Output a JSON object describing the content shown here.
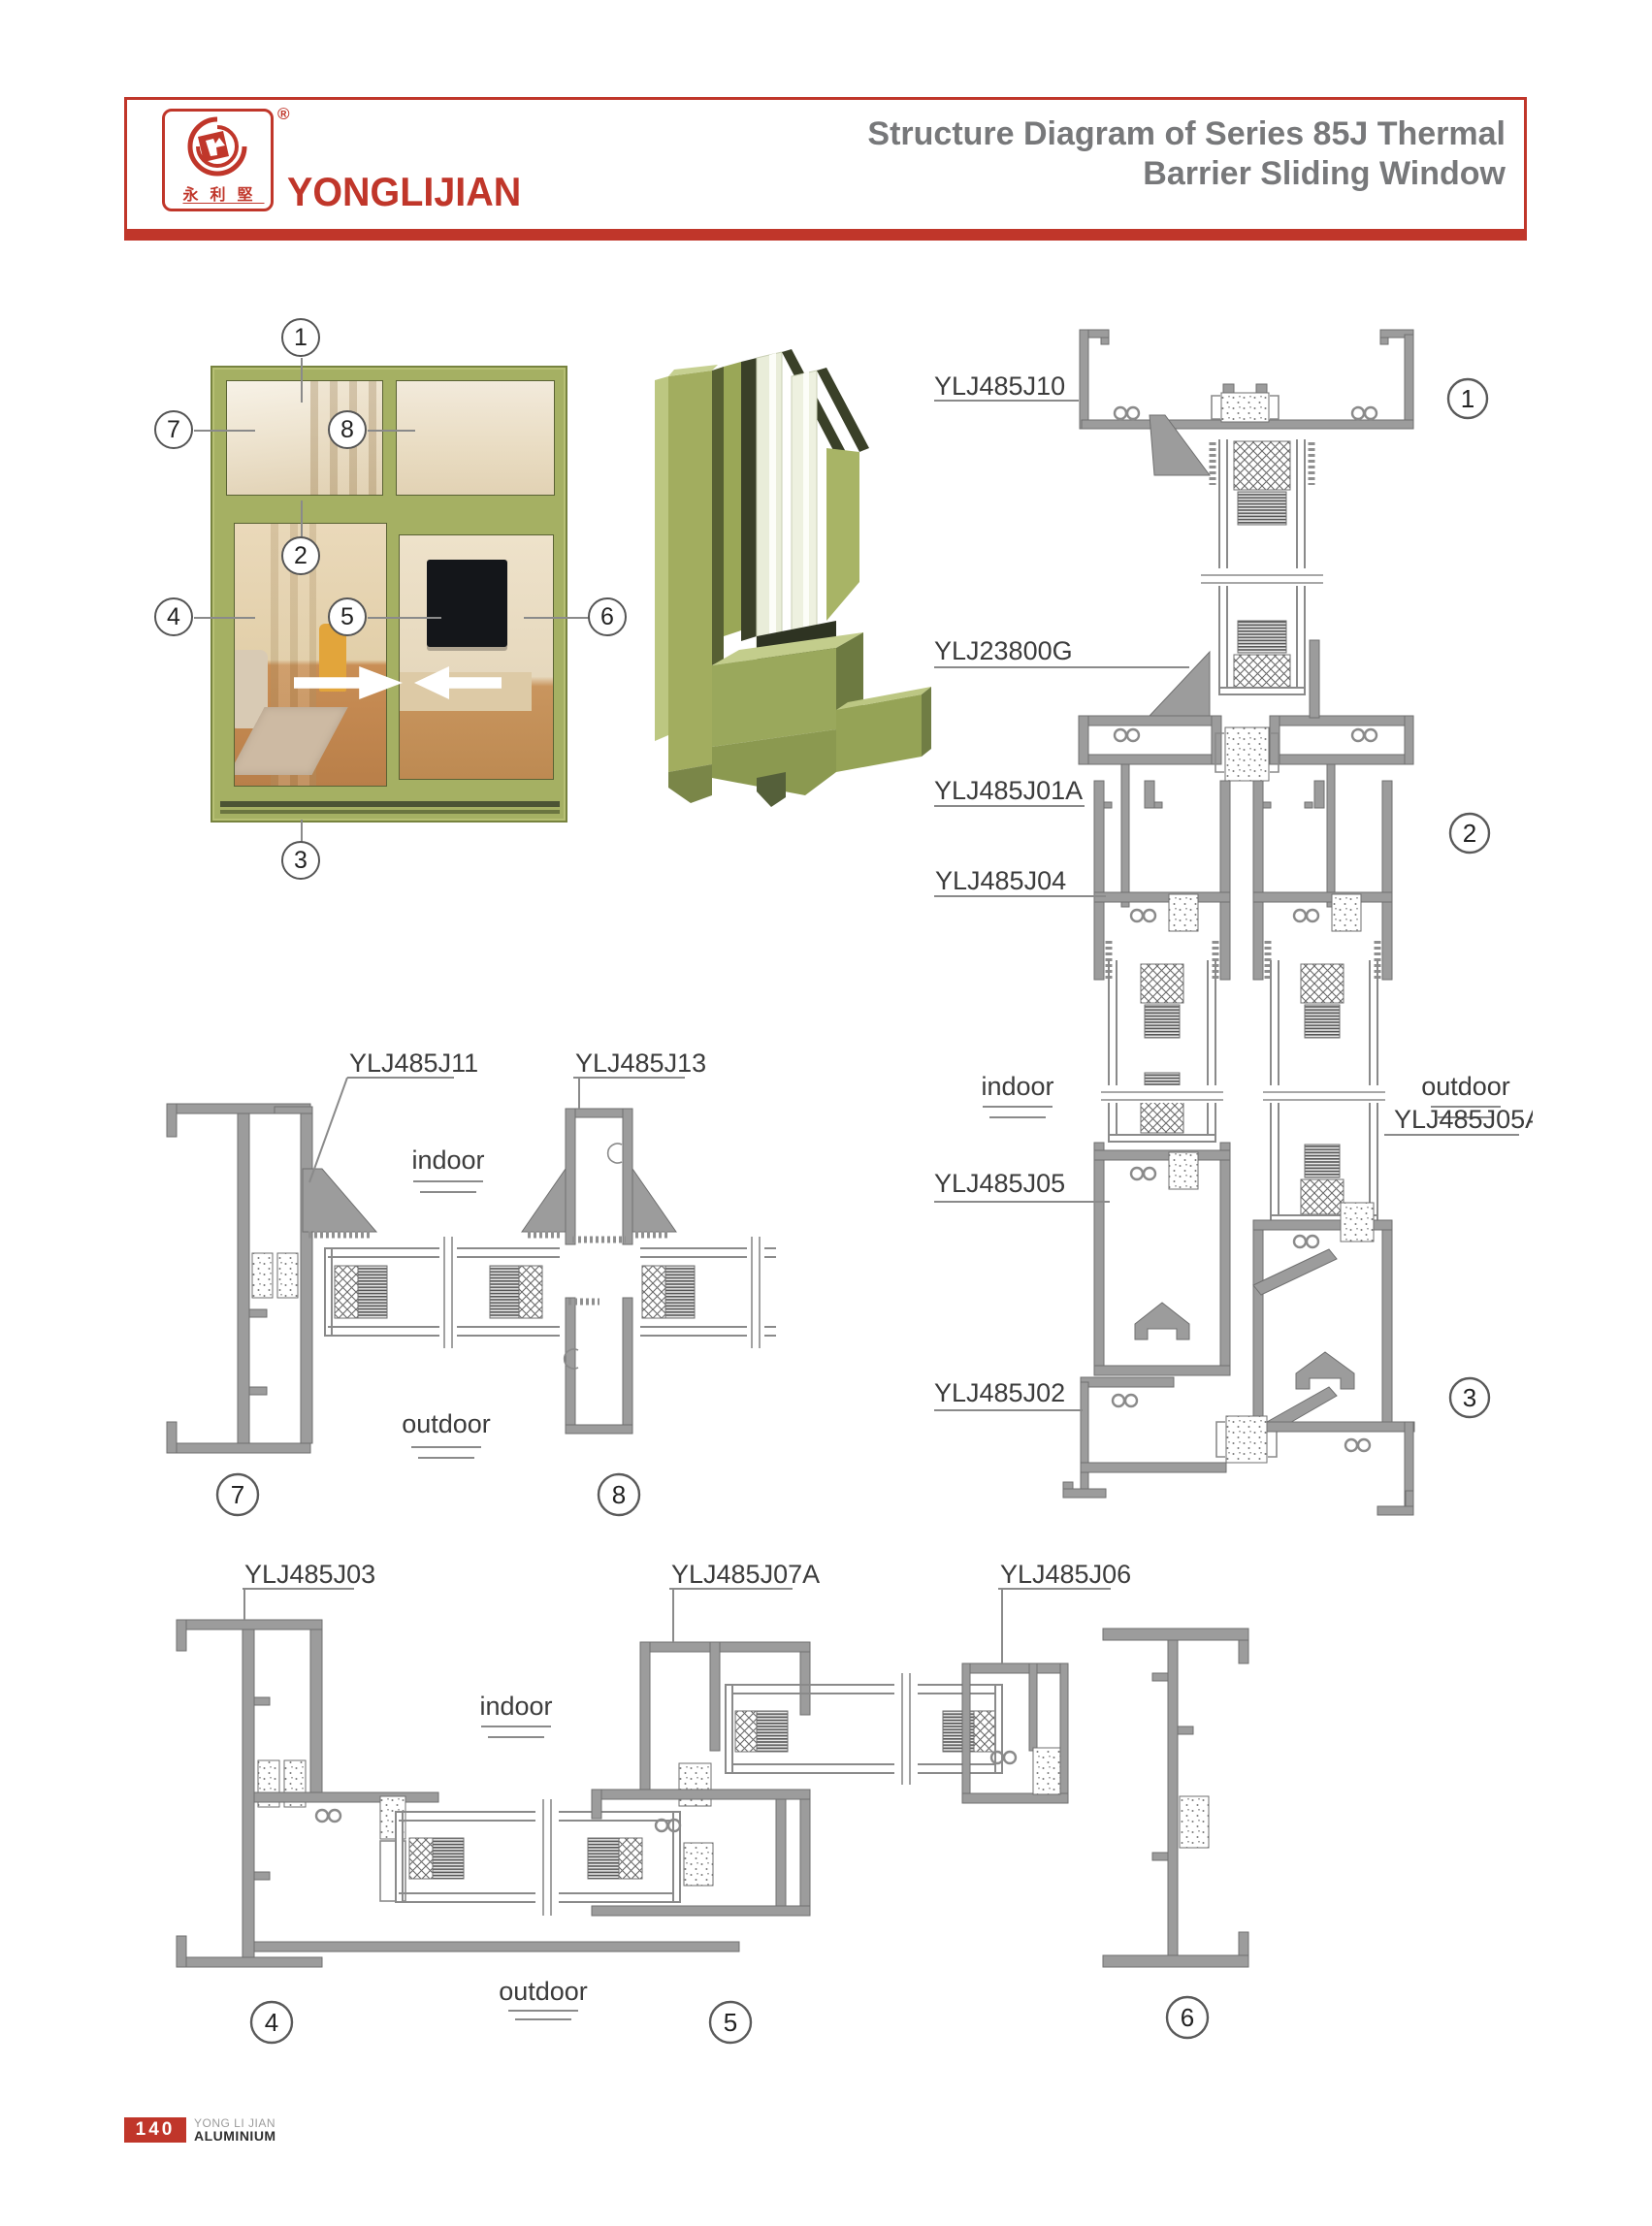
{
  "header": {
    "brand": "YONGLIJIAN",
    "brand_cn": "永利堅",
    "registered": "®",
    "title_line1": "Structure Diagram of Series 85J Thermal",
    "title_line2": "Barrier Sliding Window"
  },
  "overview": {
    "callouts": {
      "c1": "1",
      "c2": "2",
      "c3": "3",
      "c4": "4",
      "c5": "5",
      "c6": "6",
      "c7": "7",
      "c8": "8"
    }
  },
  "diagram_right": {
    "part_labels": {
      "head": "YLJ485J10",
      "corner": "YLJ23800G",
      "meeting": "YLJ485J01A",
      "track": "YLJ485J04",
      "sash_left": "YLJ485J05",
      "sash_right": "YLJ485J05A",
      "sill": "YLJ485J02"
    },
    "indoor": "indoor",
    "outdoor": "outdoor",
    "callouts": {
      "c1": "1",
      "c2": "2",
      "c3": "3"
    }
  },
  "diagram_middle": {
    "part_labels": {
      "jamb": "YLJ485J11",
      "interlock": "YLJ485J13"
    },
    "indoor": "indoor",
    "outdoor": "outdoor",
    "callouts": {
      "c7": "7",
      "c8": "8"
    }
  },
  "diagram_bottom": {
    "part_labels": {
      "jamb": "YLJ485J03",
      "interlock": "YLJ485J07A",
      "frame": "YLJ485J06"
    },
    "indoor": "indoor",
    "outdoor": "outdoor",
    "callouts": {
      "c4": "4",
      "c5": "5",
      "c6": "6"
    }
  },
  "footer": {
    "page_number": "140",
    "company_line1": "YONG LI JIAN",
    "company_line2": "ALUMINIUM"
  },
  "colors": {
    "brand_red": "#c0362a",
    "title_gray": "#77787a",
    "drawing_gray": "#8a8a8a",
    "frame_green": "#a5b063"
  }
}
